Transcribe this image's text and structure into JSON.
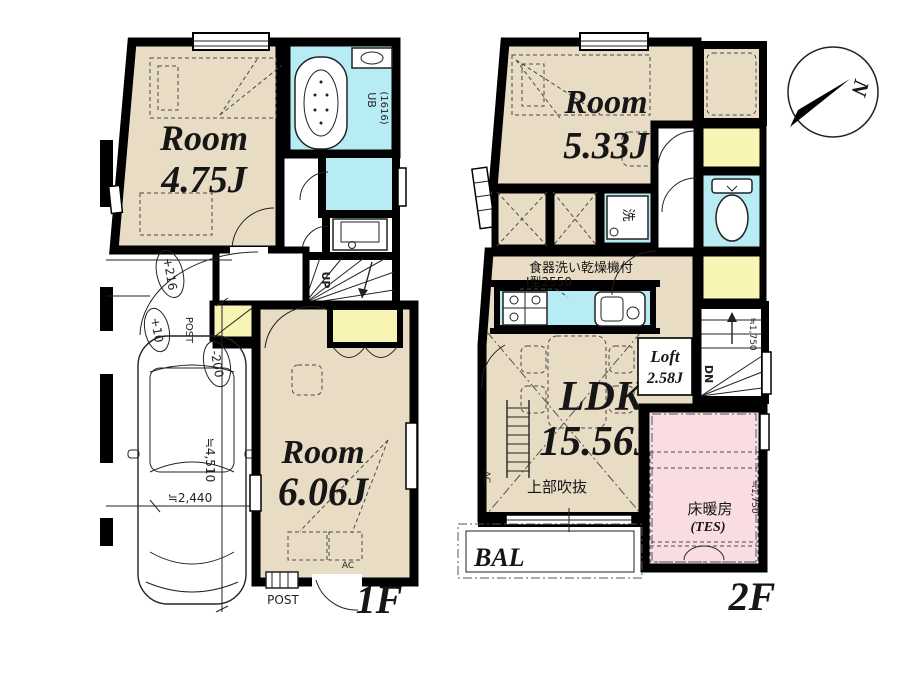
{
  "colors": {
    "wall": "#000000",
    "room_beige": "#e8dcc4",
    "wet_cyan": "#b8ecf4",
    "closet_yellow": "#f8f5b4",
    "heating_pink": "#fadde2",
    "bed_pink": "#f6ccd5",
    "post_red": "#9a5f5f"
  },
  "compass": {
    "north": "N"
  },
  "f1": {
    "label": "1F",
    "room1_name": "Room",
    "room1_size": "4.75J",
    "room2_name": "Room",
    "room2_size": "6.06J",
    "ub": "UB",
    "ub_size": "(1616)",
    "up": "UP",
    "post_entry": "POST",
    "post_box": "POST",
    "ac": "AC",
    "lv_216": "+216",
    "lv_10": "+10",
    "lv_m200": "-200",
    "car_length": "≒4,510",
    "car_width": "≒2,440"
  },
  "f2": {
    "label": "2F",
    "room_name": "Room",
    "room_size": "5.33J",
    "ldk_name": "LDK",
    "ldk_size": "15.56J",
    "loft_name": "Loft",
    "loft_size": "2.58J",
    "dishwasher": "食器洗い乾燥機付",
    "kitchen_type": "I型2550",
    "void_label": "上部吹抜",
    "heating": "床暖房",
    "heating_sub": "(TES)",
    "balcony": "BAL",
    "wash": "洗",
    "dn": "DN",
    "niche": "ニッチ",
    "ac": "AC",
    "h_a": "≒1,750",
    "h_b": "≒1,750"
  }
}
